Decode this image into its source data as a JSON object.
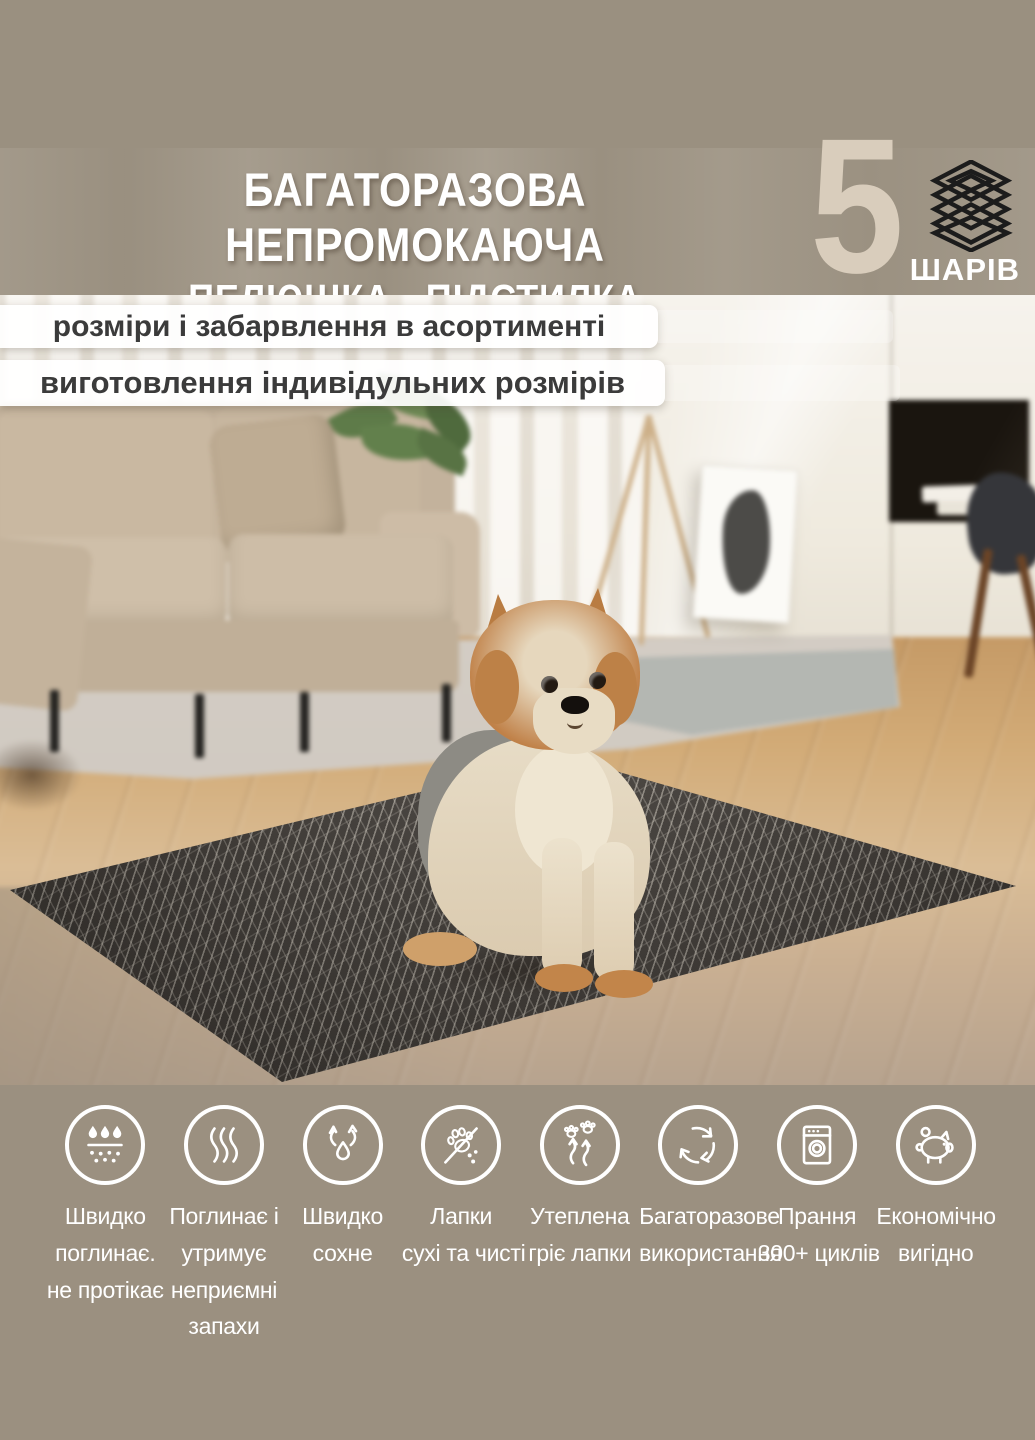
{
  "header": {
    "title_line1": "БАГАТОРАЗОВА НЕПРОМОКАЮЧА",
    "title_line2": "ПЕЛЮШКА - ПІДСТИЛКА",
    "badge": {
      "number": "5",
      "label": "ШАРІВ",
      "icon": "stacked-layers-icon"
    }
  },
  "ribbons": [
    {
      "text": "розміри і забарвлення в асортименті"
    },
    {
      "text": "виготовлення індивідульних розмірів"
    }
  ],
  "features": [
    {
      "icon": "absorb-drops-icon",
      "lines": [
        "Швидко",
        "поглинає.",
        "не протікає"
      ]
    },
    {
      "icon": "odor-lock-icon",
      "lines": [
        "Поглинає і",
        "утримує",
        "неприємні",
        "запахи"
      ]
    },
    {
      "icon": "quick-dry-icon",
      "lines": [
        "Швидко",
        "сохне"
      ]
    },
    {
      "icon": "clean-paws-icon",
      "lines": [
        "Лапки",
        "сухі та чисті"
      ]
    },
    {
      "icon": "warm-paws-icon",
      "lines": [
        "Утеплена",
        "гріє лапки"
      ]
    },
    {
      "icon": "reusable-cycle-icon",
      "lines": [
        "Багаторазове",
        "використання"
      ]
    },
    {
      "icon": "washing-machine-icon",
      "lines": [
        "Прання",
        "300+ циклів"
      ]
    },
    {
      "icon": "piggy-bank-icon",
      "lines": [
        "Економічно",
        "вигідно"
      ]
    }
  ],
  "colors": {
    "background": "#9a9080",
    "title_text": "#ffffff",
    "badge_number": "#d9cdbc",
    "layers_icon": "#1c1c1c",
    "ribbon_background": "#ffffff",
    "ribbon_text": "#3b3b3b",
    "feature_icon_stroke": "#ffffff",
    "mat_base": "#45403b",
    "mat_pattern": "#d9d0c0"
  }
}
